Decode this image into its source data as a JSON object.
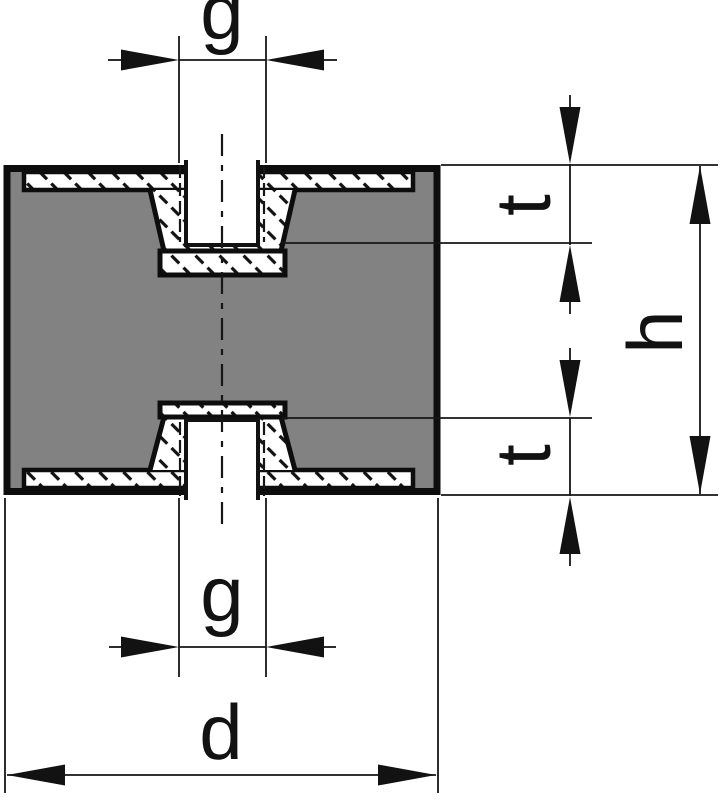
{
  "figure": {
    "colors": {
      "rubber_fill": "#828282",
      "line": "#121212",
      "metal_fill": "#ffffff",
      "background": "#ffffff"
    },
    "dimensions": {
      "thread_top": {
        "label": "g"
      },
      "thread_depth_top": {
        "label": "t"
      },
      "height": {
        "label": "h"
      },
      "thread_depth_bottom": {
        "label": "t"
      },
      "thread_bottom": {
        "label": "g"
      },
      "diameter": {
        "label": "d"
      }
    }
  }
}
